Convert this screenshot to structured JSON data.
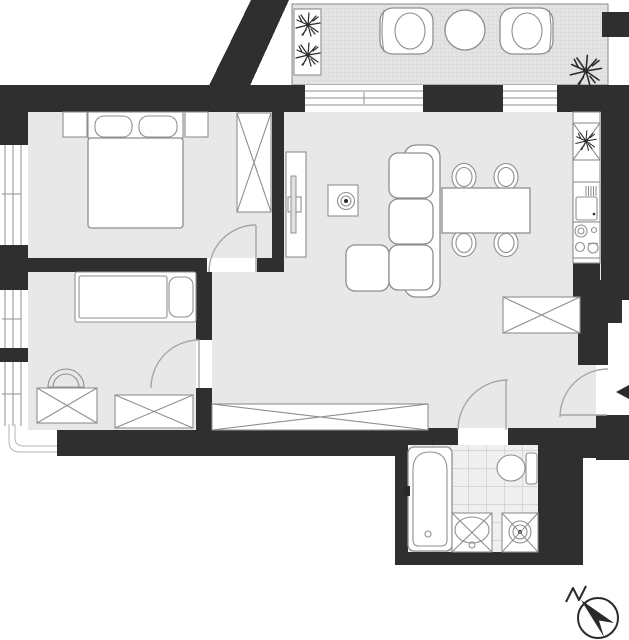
{
  "title": "Apartment floor plan",
  "colors": {
    "wall": "#2f2f2f",
    "floor": "#e8e8e8",
    "balcony-floor": "#e4e4e4",
    "tile-floor": "#efefef",
    "mesh": "#cbcbcb",
    "tile-line": "#bdbdbd",
    "line": "#8f8f8f",
    "line-dark": "#2a2a2a",
    "door": "#a6a6a6",
    "facade": "#b3b3b3"
  },
  "plan": {
    "balcony": {
      "items": [
        "planter-box",
        "lounge-chair",
        "round-table",
        "lounge-chair",
        "potted-plant"
      ]
    },
    "bedroom": {
      "items": [
        "nightstand",
        "double-bed-with-two-pillows",
        "nightstand",
        "crossed-wardrobe"
      ]
    },
    "second-bedroom": {
      "items": [
        "single-bed-with-pillow",
        "tub-chair",
        "crossed-dresser",
        "crossed-dresser"
      ]
    },
    "living-room": {
      "items": [
        "tv-cabinet",
        "tv",
        "side-table-with-plant",
        "three-seat-sofa",
        "ottoman",
        "dining-table",
        "four-chairs",
        "crossed-wardrobe"
      ]
    },
    "kitchen-run": {
      "items": [
        "sink-cabinet-crossed",
        "counter",
        "refrigerator",
        "cooktop-four-burners"
      ]
    },
    "hallway": {
      "items": [
        "built-in-closet-crossed"
      ]
    },
    "bathroom": {
      "items": [
        "bathtub",
        "toilet",
        "washbasin-crossed",
        "washing-machine-crossed"
      ]
    },
    "doors": [
      "bedroom-door",
      "second-bedroom-door",
      "bathroom-door",
      "entrance-door"
    ],
    "windows": [
      "left-window-1",
      "left-window-2",
      "left-window-3",
      "balcony-window-1",
      "balcony-window-2"
    ],
    "compass": "north-arrow",
    "entry_marker": "left-pointing-arrow"
  }
}
